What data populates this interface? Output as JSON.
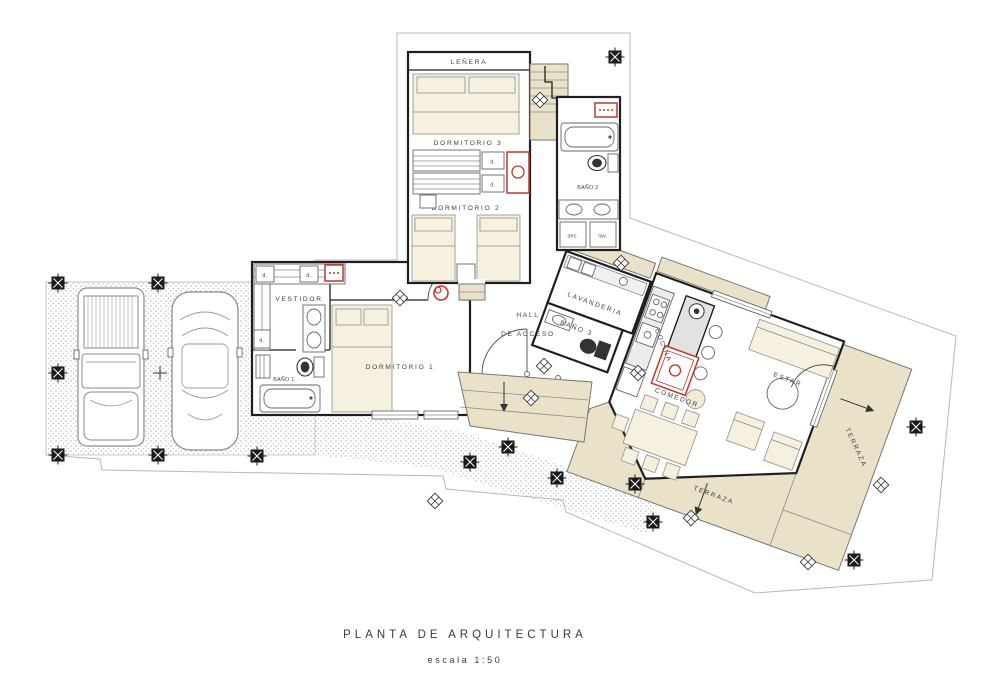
{
  "title": {
    "main": "PLANTA DE ARQUITECTURA",
    "scale_label": "escala 1:50"
  },
  "rooms": {
    "lenera": "LEÑERA",
    "dormitorio3": "DORMITORIO 3",
    "dormitorio2": "DORMITORIO 2",
    "dormitorio1": "DORMITORIO 1",
    "bano1": "BAÑO 1",
    "bano2": "BAÑO 2",
    "bano3": "BAÑO 3",
    "vestidor": "VESTIDOR",
    "lavanderia": "LAVANDERIA",
    "hall_line1": "HALL",
    "hall_line2": "DE ACCESO",
    "cocina": "COCINA",
    "estar": "ESTAR",
    "comedor": "COMEDOR",
    "terraza": "TERRAZA"
  },
  "annotations": {
    "closet": "d.",
    "dryer": "sec.",
    "washer": "lav."
  },
  "symbols": {
    "column": "column-marker",
    "ceiling_light": "ceiling-light-icon",
    "wood_stove": "wood-stove-icon",
    "cooktop": "cooktop-icon",
    "electrical_box": "electrical-box-icon",
    "slope_arrow": "slope-arrow-icon"
  },
  "colors": {
    "wall": "#1f1f1f",
    "furniture_fill": "#f6f0df",
    "terrace_fill": "#eae2c8",
    "counter_fill": "#ececec",
    "accent_red": "#c0392b",
    "boundary_line": "#b8b8b8",
    "label_text": "#3f3f3f"
  }
}
